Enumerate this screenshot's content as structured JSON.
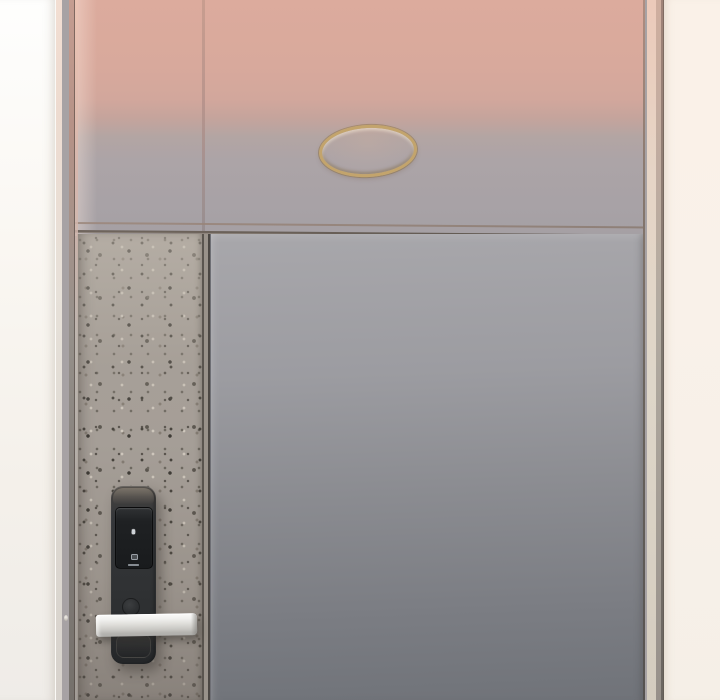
{
  "scene": {
    "subject": "apartment-door-with-digital-keypad-lock",
    "colors": {
      "door_top_tint": "#dcab9d",
      "door_panel_gray": "#8b8c91",
      "door_panel_gray_dark": "#707379",
      "speckle_panel_base": "#a59e97",
      "peephole_gold": "#c3a46c",
      "lock_body": "#303234",
      "handle_silver": "#dfdeda",
      "wall_left_white": "#faf7f2",
      "wall_right_cream": "#f9f1e9"
    }
  },
  "door": {
    "lock": {
      "keypad_keys": [
        "1",
        "2",
        "3",
        "4",
        "5",
        "6",
        "7",
        "8",
        "9",
        "*",
        "0",
        "#"
      ]
    }
  }
}
